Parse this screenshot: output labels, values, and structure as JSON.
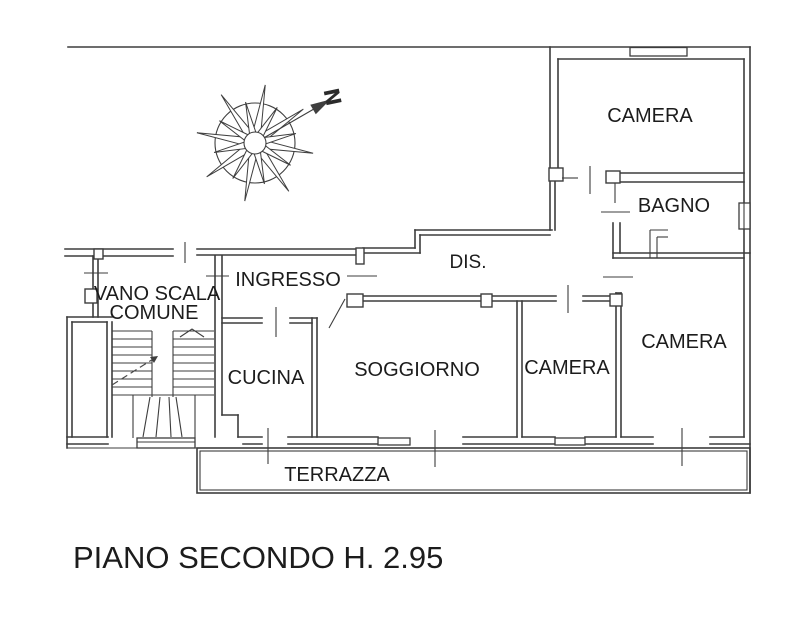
{
  "title": "PIANO SECONDO H. 2.95",
  "compass": {
    "north_label": "N"
  },
  "rooms": {
    "camera_ne": "CAMERA",
    "bagno": "BAGNO",
    "dis": "DIS.",
    "ingresso": "INGRESSO",
    "vano_scala_line1": "VANO SCALA",
    "vano_scala_line2": "COMUNE",
    "cucina": "CUCINA",
    "soggiorno": "SOGGIORNO",
    "camera_center": "CAMERA",
    "camera_se": "CAMERA",
    "terrazza": "TERRAZZA"
  },
  "colors": {
    "background": "#ffffff",
    "wall": "#3d3d3d",
    "text": "#1c1c1c"
  }
}
